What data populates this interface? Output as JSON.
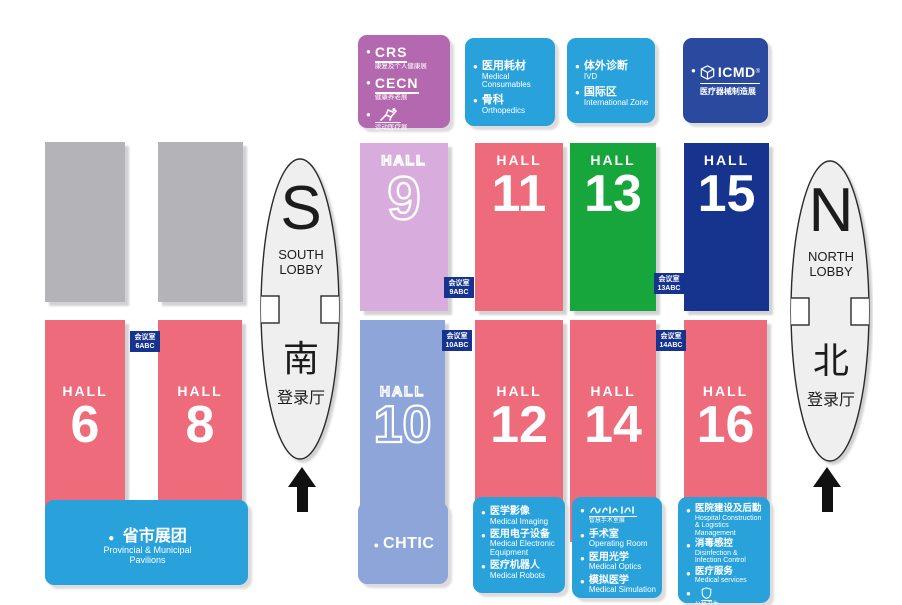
{
  "colors": {
    "hall_red": "#ee6b7b",
    "hall_green": "#17a63b",
    "hall_navy": "#16338e",
    "hall_lavender": "#d8acdc",
    "hall_periwinkle": "#8da5d8",
    "legend_blue": "#29a2db",
    "legend_purple": "#b468b0",
    "legend_darkblue": "#2a4a9f",
    "meeting_chip_navy": "#16338e",
    "gray_block": "#b4b4b8",
    "lobby_fill": "#efefef",
    "arrow_black": "#111111"
  },
  "halls": [
    {
      "word": "HALL",
      "number": "6"
    },
    {
      "word": "HALL",
      "number": "8"
    },
    {
      "word": "HALL",
      "number": "9"
    },
    {
      "word": "HALL",
      "number": "10"
    },
    {
      "word": "HALL",
      "number": "11"
    },
    {
      "word": "HALL",
      "number": "12"
    },
    {
      "word": "HALL",
      "number": "13"
    },
    {
      "word": "HALL",
      "number": "14"
    },
    {
      "word": "HALL",
      "number": "15"
    },
    {
      "word": "HALL",
      "number": "16"
    }
  ],
  "meeting_rooms": [
    {
      "label": "会议室",
      "code": "6ABC"
    },
    {
      "label": "会议室",
      "code": "9ABC"
    },
    {
      "label": "会议室",
      "code": "10ABC"
    },
    {
      "label": "会议室",
      "code": "13ABC"
    },
    {
      "label": "会议室",
      "code": "14ABC"
    }
  ],
  "lobbies": {
    "south": {
      "letter": "S",
      "line1": "SOUTH",
      "line2": "LOBBY",
      "cn": "南",
      "cn_sub": "登录厅"
    },
    "north": {
      "letter": "N",
      "line1": "NORTH",
      "line2": "LOBBY",
      "cn": "北",
      "cn_sub": "登录厅"
    }
  },
  "legend_purple": {
    "crs": {
      "logo": "CRS",
      "subtitle": "康复及个人健康展"
    },
    "cecn": {
      "logo": "CECN",
      "subtitle": "健康养老展"
    },
    "sports": {
      "icon": "runner-icon",
      "subtitle": "运动医疗展"
    }
  },
  "legend_consumables": {
    "items": [
      {
        "cn": "医用耗材",
        "en": "Medical Consumables"
      },
      {
        "cn": "骨科",
        "en": "Orthopedics"
      }
    ]
  },
  "legend_ivd": {
    "items": [
      {
        "cn": "体外诊断",
        "en": "IVD"
      },
      {
        "cn": "国际区",
        "en": "International Zone"
      }
    ]
  },
  "legend_icmd": {
    "logo": "ICMD",
    "logo_sup": "®",
    "subtitle": "医疗器械制造展"
  },
  "legend_provincial": {
    "cn": "省市展团",
    "en_line1": "Provincial & Municipal",
    "en_line2": "Pavilions"
  },
  "legend_chtic": {
    "logo": "CHTIC"
  },
  "legend_hall12": {
    "items": [
      {
        "cn": "医学影像",
        "en": "Medical Imaging"
      },
      {
        "cn": "医用电子设备",
        "en": "Medical Electronic Equipment"
      },
      {
        "cn": "医疗机器人",
        "en": "Medical Robots"
      }
    ]
  },
  "legend_hall14": {
    "logo_subtitle": "智慧手术室展",
    "items": [
      {
        "cn": "手术室",
        "en": "Operating Room"
      },
      {
        "cn": "医用光学",
        "en": "Medical Optics"
      },
      {
        "cn": "模拟医学",
        "en": "Medical Simulation"
      }
    ]
  },
  "legend_hall16": {
    "items": [
      {
        "cn": "医院建设及后勤",
        "en": "Hospital Construction & Logistics Management"
      },
      {
        "cn": "消毒感控",
        "en": "Disinfection & Infection Control"
      },
      {
        "cn": "医疗服务",
        "en": "Medical services"
      }
    ],
    "shield_subtitle": "公共卫生",
    "amc_logo": "AMC",
    "amc_subtitle": "应急医疗"
  }
}
